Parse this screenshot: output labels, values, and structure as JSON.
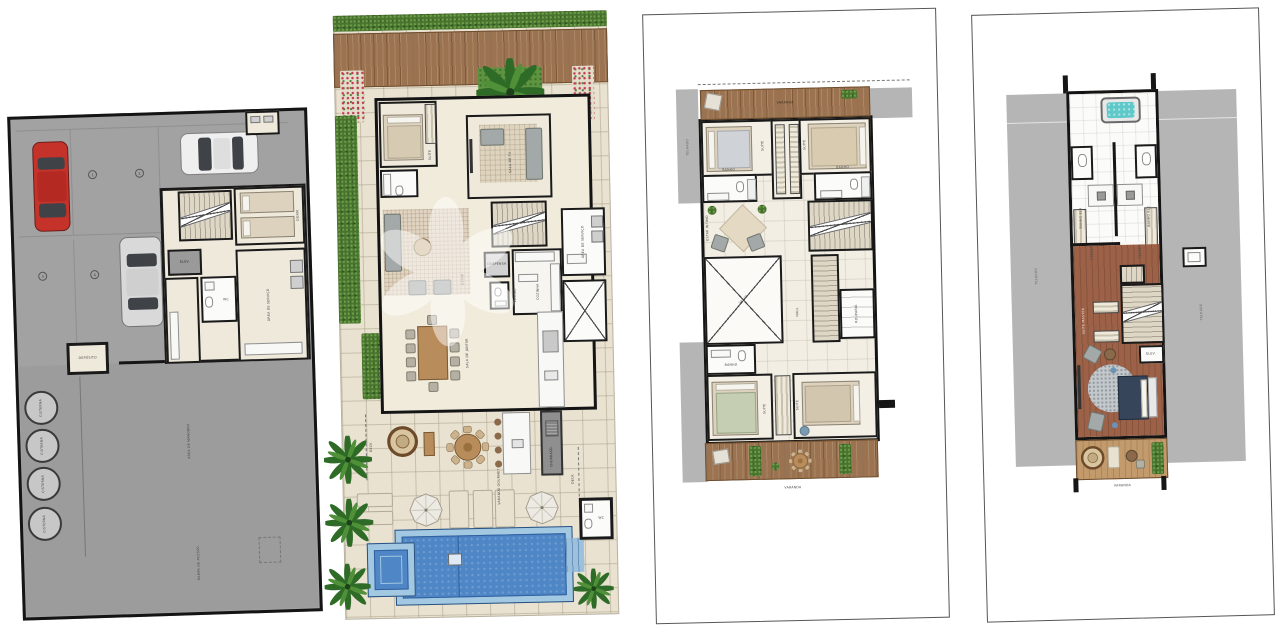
{
  "colors": {
    "wall": "#1a1a1a",
    "paving": "#e9e2d1",
    "garage_floor": "#a2a2a2",
    "roof_gray": "#b5b5b5",
    "hedge_green": "#48742f",
    "deck_wood": "#9b7350",
    "bedroom_wood": "#9c6147",
    "pool_water": "#4f86c6",
    "pool_rim": "#a3c8e2",
    "spa_teal": "#5fc8c8",
    "car_red": "#c4322a",
    "room_beige": "#efe9db"
  },
  "plans": {
    "basement": {
      "parking_spots": [
        "1",
        "2",
        "3",
        "4"
      ],
      "rooms": {
        "deposito": "DEPÓSITO",
        "elevador": "ELEV.",
        "dorm_servico": "DORM.",
        "area_servico": "ÁREA DE SERVIÇO",
        "wc": "WC",
        "cisterna": "CISTERNA",
        "manobra": "ÁREA DE MANOBRA",
        "rampa": "RAMPA DE ACESSO"
      }
    },
    "terreo": {
      "rooms": {
        "suite": "SUÍTE",
        "sala_tv": "SALA DE TV",
        "lavabo": "LAVABO",
        "despensa": "DESPENSA",
        "cozinha": "COZINHA",
        "area_servico": "ÁREA DE SERVIÇO",
        "estar": "ESTAR",
        "jantar": "SALA DE JANTAR",
        "gourmet": "VARANDA GOURMET",
        "churrasqueira": "CHURRASQ.",
        "deck": "DECK",
        "wc": "WC"
      }
    },
    "superior": {
      "rooms": {
        "varanda": "VARANDA",
        "suite": "SUÍTE",
        "banho": "BANHO",
        "estar_intimo": "ESTAR ÍNTIMO",
        "vazio": "VAZIO",
        "hall": "HALL",
        "rouparia": "ROUPARIA",
        "telhado": "TELHADO"
      }
    },
    "cobertura": {
      "rooms": {
        "banho_ela": "BANHO ELA",
        "banho_ele": "BANHO ELE",
        "closet": "CLOSET",
        "suite_master": "SUÍTE MASTER",
        "varanda": "VARANDA",
        "elevador": "ELEV.",
        "telhado": "TELHADO"
      }
    }
  }
}
